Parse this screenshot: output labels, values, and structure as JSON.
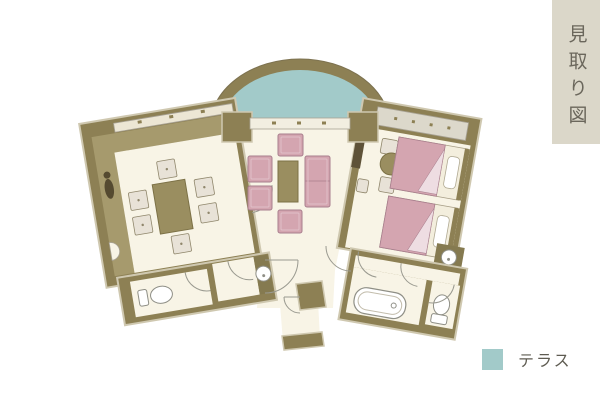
{
  "page": {
    "background": "#ffffff"
  },
  "sidebar": {
    "title": "見取り図",
    "bg": "#dbd7c9",
    "text_color": "#6b675c"
  },
  "legend": {
    "label": "テラス",
    "swatch_color": "#a2cac9",
    "text_color": "#5e5b51"
  },
  "palette": {
    "wall": "#8d8054",
    "wall_light": "#a69a6d",
    "floor": "#f8f4e6",
    "terrace": "#a2cac9",
    "furniture_pink": "#d4a5b0",
    "furniture_pink_border": "#a87e8d",
    "wood_table": "#9a8e60",
    "cushion": "#e8e2d7",
    "closet": "#dcd8cb",
    "fixture_white": "#ffffff",
    "fixture_stroke": "#8f8f86"
  },
  "floorplan": {
    "terrace": {
      "shape": "semicircular dome at top",
      "color_key": "terrace"
    },
    "japanese_room": {
      "furniture": [
        "low-table",
        "floor-cushion x6",
        "ornament"
      ]
    },
    "living_room": {
      "furniture": [
        "coffee-table",
        "armchair x4",
        "sofa"
      ]
    },
    "bedroom": {
      "furniture": [
        "bed x2",
        "round-table",
        "chair x2",
        "stool",
        "closet",
        "tv-board"
      ]
    },
    "sanitary_left": [
      "toilet",
      "washbasin"
    ],
    "sanitary_right": [
      "bathtub",
      "toilet",
      "washbasin"
    ]
  }
}
